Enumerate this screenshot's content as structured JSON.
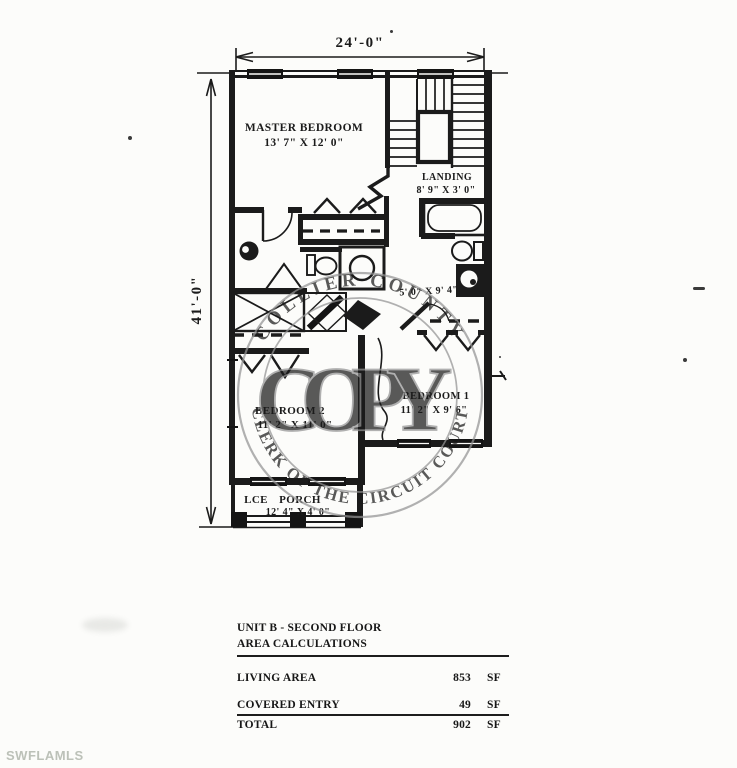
{
  "brand": "SWFLAMLS",
  "stamp": {
    "center_text": "COPY",
    "top_arc": "COLLIER COUNTY",
    "bottom_arc": "CLERK OF THE CIRCUIT COURT"
  },
  "dimensions": {
    "overall_width": "24'-0\"",
    "overall_height": "41'-0\""
  },
  "rooms": {
    "master": {
      "name": "MASTER BEDROOM",
      "size": "13' 7\" X 12' 0\""
    },
    "landing": {
      "name": "LANDING",
      "size": "8' 9\" X 3' 0\""
    },
    "hall": {
      "size": "5' 0\" X 9' 4\""
    },
    "bedroom2": {
      "name": "BEDROOM 2",
      "size": "11' 2\" X 11' 0\""
    },
    "bedroom1": {
      "name": "BEDROOM 1",
      "size": "11' 2\" X 9' 6\""
    },
    "porch": {
      "name_lce": "LCE",
      "name_porch": "PORCH",
      "size": "12' 4\" X 4' 0\""
    }
  },
  "table": {
    "title_line1": "UNIT B - SECOND FLOOR",
    "title_line2": "AREA CALCULATIONS",
    "rows": [
      {
        "label": "LIVING AREA",
        "value": "853",
        "unit": "SF"
      },
      {
        "label": "COVERED ENTRY",
        "value": "49",
        "unit": "SF"
      }
    ],
    "total": {
      "label": "TOTAL",
      "value": "902",
      "unit": "SF"
    }
  }
}
